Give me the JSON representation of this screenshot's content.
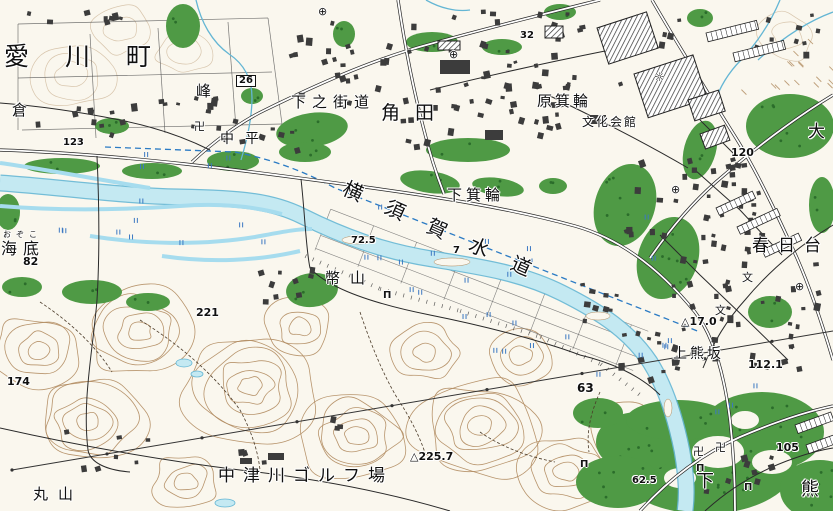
{
  "map": {
    "labels": [
      {
        "id": "aikawa-machi",
        "text": "愛川町",
        "kind": "town"
      },
      {
        "id": "kura",
        "text": "倉",
        "kind": "place"
      },
      {
        "id": "mine",
        "text": "峰",
        "kind": "place"
      },
      {
        "id": "route-26",
        "text": "26",
        "kind": "boxed-number"
      },
      {
        "id": "shimono-kaido",
        "text": "下之街道",
        "kind": "place"
      },
      {
        "id": "tsunoda",
        "text": "角田",
        "kind": "place"
      },
      {
        "id": "elev-32",
        "text": "32",
        "kind": "elevation"
      },
      {
        "id": "hara-minowa",
        "text": "原箕輪",
        "kind": "place"
      },
      {
        "id": "bunka-kaikan",
        "text": "文化会館",
        "kind": "facility"
      },
      {
        "id": "dai",
        "text": "大",
        "kind": "place-partial"
      },
      {
        "id": "elev-120",
        "text": "120",
        "kind": "elevation"
      },
      {
        "id": "nakahira",
        "text": "中平",
        "kind": "place"
      },
      {
        "id": "elev-123",
        "text": "123",
        "kind": "elevation"
      },
      {
        "id": "ozoko-furigana",
        "text": "おぞこ",
        "kind": "furigana"
      },
      {
        "id": "ozoko",
        "text": "海底",
        "kind": "place"
      },
      {
        "id": "elev-82",
        "text": "82",
        "kind": "elevation"
      },
      {
        "id": "yokosuka-suido",
        "text": "横須賀水道",
        "kind": "waterway"
      },
      {
        "id": "shimo-minowa",
        "text": "下箕輪",
        "kind": "place"
      },
      {
        "id": "elev-72-5",
        "text": "72.5",
        "kind": "elevation"
      },
      {
        "id": "parcel-7",
        "text": "7",
        "kind": "number"
      },
      {
        "id": "heisan",
        "text": "幣山",
        "kind": "place"
      },
      {
        "id": "kasugadai",
        "text": "春日台",
        "kind": "place"
      },
      {
        "id": "elev-17-0",
        "text": "△17.0",
        "kind": "triangulation"
      },
      {
        "id": "kami-kumasaka",
        "text": "上熊坂",
        "kind": "place"
      },
      {
        "id": "elev-112-1",
        "text": "112.1",
        "kind": "elevation"
      },
      {
        "id": "elev-63",
        "text": "63",
        "kind": "elevation"
      },
      {
        "id": "elev-105",
        "text": "105",
        "kind": "elevation"
      },
      {
        "id": "elev-221",
        "text": "221",
        "kind": "elevation"
      },
      {
        "id": "elev-174",
        "text": "174",
        "kind": "elevation"
      },
      {
        "id": "nakatsugawa-golf",
        "text": "中津川ゴルフ場",
        "kind": "facility"
      },
      {
        "id": "elev-225-7",
        "text": "△225.7",
        "kind": "triangulation"
      },
      {
        "id": "elev-62-5",
        "text": "62.5",
        "kind": "elevation"
      },
      {
        "id": "maruyama",
        "text": "丸山",
        "kind": "place"
      },
      {
        "id": "shimo",
        "text": "下",
        "kind": "place-partial"
      },
      {
        "id": "kuma",
        "text": "熊",
        "kind": "place-partial"
      }
    ],
    "symbols": [
      {
        "id": "temple-nakahira",
        "glyph": "卍"
      },
      {
        "id": "temple-shimokumasaka-1",
        "glyph": "卍"
      },
      {
        "id": "temple-shimokumasaka-2",
        "glyph": "卍"
      },
      {
        "id": "shrine-heisan",
        "glyph": "П"
      },
      {
        "id": "shrine-riverside",
        "glyph": "П"
      },
      {
        "id": "shrine-shimokumasaka-1",
        "glyph": "П"
      },
      {
        "id": "shrine-shimokumasaka-2",
        "glyph": "П"
      },
      {
        "id": "school-kasugadai-north",
        "glyph": "文"
      },
      {
        "id": "school-kasugadai-south",
        "glyph": "文"
      },
      {
        "id": "post-office-kasugadai-1",
        "glyph": "⊕"
      },
      {
        "id": "post-office-kasugadai-2",
        "glyph": "⊕"
      },
      {
        "id": "facility-tsunoda",
        "glyph": "⊕"
      },
      {
        "id": "facility-north",
        "glyph": "⊕"
      },
      {
        "id": "factory-minowa",
        "glyph": "☼"
      }
    ],
    "colors": {
      "paper": "#faf7ee",
      "contour": "#b08a5e",
      "water_fill": "#c4e9f2",
      "water_light": "#a6dcee",
      "water_line": "#64b6d4",
      "vegetation": "#4f9a45",
      "tree_dot": "#2b6d2b",
      "building": "#3c3c3c",
      "road_casing": "#262626",
      "road_fill": "#ffffff",
      "paddy_mark": "#3b78c2",
      "pipeline": "#2b7bc4",
      "label": "#101010"
    }
  }
}
